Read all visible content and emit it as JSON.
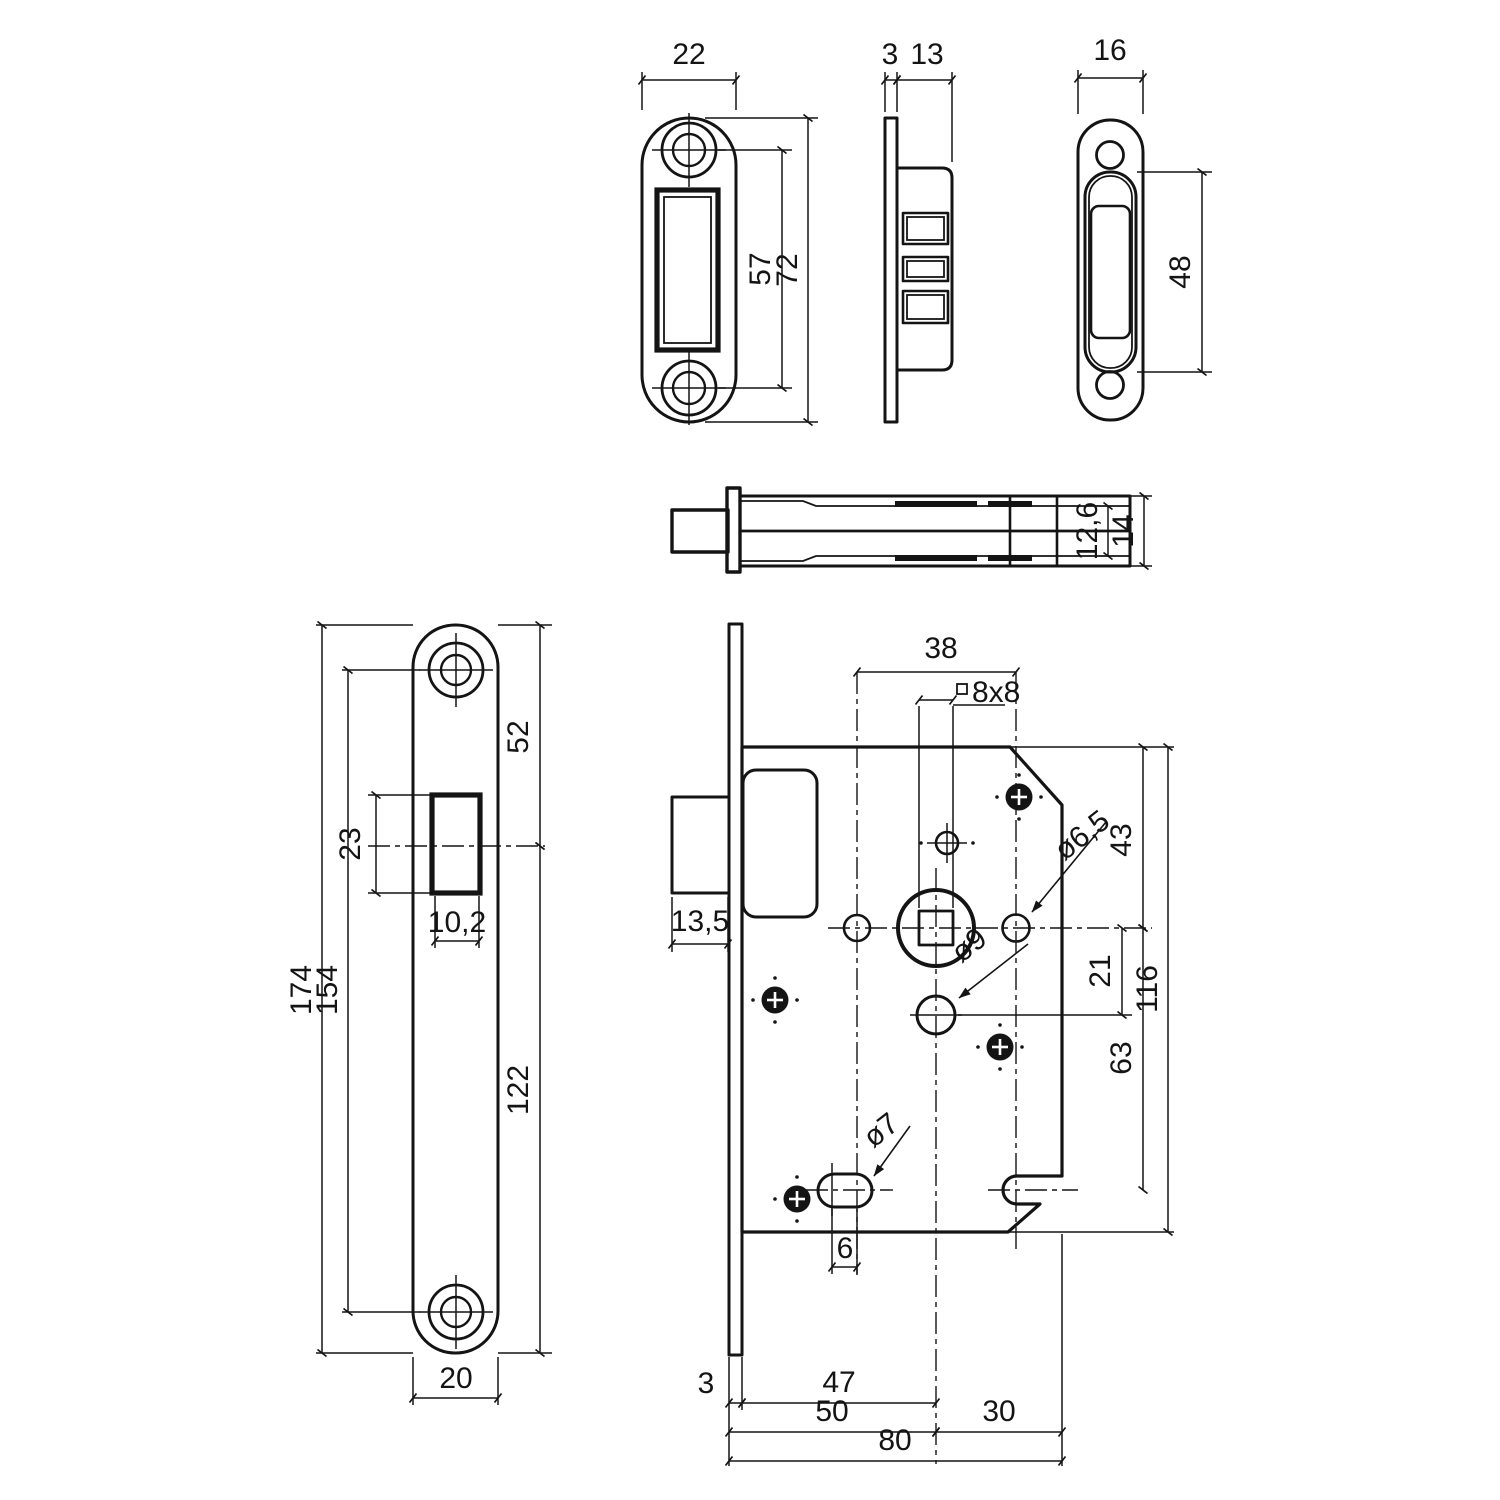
{
  "drawing": {
    "background": "#ffffff",
    "line_color": "#141414",
    "units_note": ""
  },
  "views": {
    "strike_plate_front": {
      "width": "22",
      "screw_spacing": "57",
      "height": "72"
    },
    "strike_plate_side": {
      "plate_thickness": "3",
      "body_depth": "13"
    },
    "oval_plate_front": {
      "width": "16",
      "slot_height": "48"
    },
    "latch_bolt_top": {
      "body_inner_height": "12,6",
      "body_height": "14"
    },
    "faceplate_front": {
      "top_to_center": "52",
      "window_height": "23",
      "window_width": "10,2",
      "total_height": "174",
      "screw_spacing": "154",
      "center_to_bottom": "122",
      "width": "20"
    },
    "lock_case_front": {
      "hole_spacing": "38",
      "spindle_square": "8x8",
      "top_to_center": "43",
      "cylinder_hole": "ø6,5",
      "follower_hole": "ø9",
      "center_to_follower": "21",
      "case_height": "116",
      "center_to_slot": "63",
      "bolt_depth": "13,5",
      "slot_hole": "ø7",
      "slot_length": "6",
      "faceplate_thickness": "3",
      "backset_inner": "47",
      "backset": "50",
      "rear_section": "30",
      "total_width": "80"
    }
  }
}
